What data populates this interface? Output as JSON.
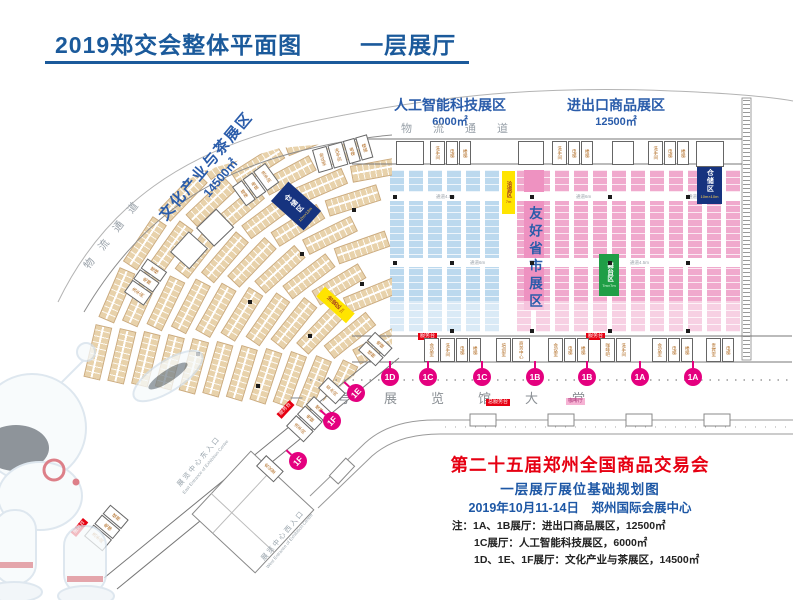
{
  "header": {
    "title": "2019郑交会整体平面图",
    "subtitle": "一层展厅"
  },
  "zones": {
    "ai_label": "人工智能科技展区",
    "ai_area": "6000㎡",
    "ie_label": "进出口商品展区",
    "ie_area": "12500㎡",
    "culture_label": "文化产业与茶展区",
    "culture_area": "14500㎡",
    "friendly_label": "友好省市展区"
  },
  "corridors": {
    "top": "物流通道",
    "left": "物流通道",
    "lobby": "一号展览馆大堂",
    "aisle": "通道4.5m",
    "aisle2": "通道6m"
  },
  "facilities": {
    "storage": "仓储区",
    "storage1_size": "10m×10m",
    "storage2_size": "12m×12m",
    "negotiation": "洽谈区",
    "negotiation_size": "7m",
    "stage": "舞台区",
    "stage_size": "7m×7m",
    "service_desk": "服务台",
    "main_service_desk": "总服务台",
    "cafe": "咖啡厅"
  },
  "gates": {
    "bottom": [
      "1D",
      "1C",
      "1C",
      "1B",
      "1B",
      "1A",
      "1A"
    ],
    "diagonal": [
      "1E",
      "1F",
      "1F"
    ]
  },
  "walls": {
    "top_clusters": [
      {
        "x": 430,
        "rooms": [
          "洗手间",
          "电梯",
          "楼梯"
        ]
      },
      {
        "x": 552,
        "rooms": [
          "洗手间",
          "电梯",
          "楼梯"
        ]
      },
      {
        "x": 648,
        "rooms": [
          "洗手间",
          "电梯",
          "楼梯"
        ]
      }
    ],
    "arc_clusters": [
      {
        "x": 312,
        "y": 150,
        "rot": -16,
        "rooms": [
          "会议室",
          "洗手间",
          "电梯",
          "楼梯"
        ]
      },
      {
        "x": 232,
        "y": 187,
        "rot": -36,
        "rooms": [
          "楼梯",
          "电梯",
          "洗手间"
        ]
      },
      {
        "x": 124,
        "y": 292,
        "rot": -55,
        "rooms": [
          "洗手间",
          "电梯",
          "楼梯"
        ]
      }
    ],
    "diag_clusters": [
      {
        "x": 358,
        "y": 350,
        "rot": -47,
        "rooms": [
          "楼梯",
          "电梯"
        ]
      },
      {
        "x": 318,
        "y": 388,
        "rot": -47,
        "rooms": [
          "茶水间"
        ]
      },
      {
        "x": 286,
        "y": 426,
        "rot": -47,
        "rooms": [
          "洗手间",
          "电梯",
          "楼梯"
        ]
      },
      {
        "x": 256,
        "y": 466,
        "rot": -47,
        "rooms": [
          "会议室"
        ]
      },
      {
        "x": 84,
        "y": 536,
        "rot": -50,
        "rooms": [
          "洗手间",
          "电梯",
          "楼梯"
        ]
      }
    ],
    "bottom_clusters": [
      {
        "x": 424,
        "rooms": [
          "会议室",
          "洗手间",
          "电梯",
          "楼梯"
        ]
      },
      {
        "x": 496,
        "rooms": [
          "培训室",
          "商务中心"
        ]
      },
      {
        "x": 548,
        "rooms": [
          "会议室",
          "电梯",
          "楼梯"
        ]
      },
      {
        "x": 600,
        "rooms": [
          "咖啡吧",
          "洗手间"
        ]
      },
      {
        "x": 652,
        "rooms": [
          "会议室",
          "电梯",
          "楼梯"
        ]
      },
      {
        "x": 706,
        "rooms": [
          "贵宾室",
          "电梯"
        ]
      }
    ]
  },
  "entrances": {
    "east_cn": "展览中心东入口",
    "east_en": "East Entrance of Exhibition Centre",
    "west_cn": "展览中心西入口",
    "west_en": "West Entrance of Exhibition Centre"
  },
  "footer": {
    "title": "第二十五届郑州全国商品交易会",
    "subtitle": "一层展厅展位基础规划图",
    "date_venue": "2019年10月11-14日　郑州国际会展中心",
    "notes": [
      "注：1A、1B展厅：进出口商品展区，12500㎡",
      "1C展厅：人工智能科技展区，6000㎡",
      "1D、1E、1F展厅：文化产业与茶展区，14500㎡"
    ]
  },
  "colors": {
    "title_blue": "#1b5a9b",
    "zone_blue": "#2a5caa",
    "red": "#e60012",
    "badge_pink": "#e4007f",
    "booth_pink": "#f0a9cd",
    "booth_blue": "#bcd9ee",
    "booth_tan": "#e8d2ab",
    "storage_blue": "#16337f",
    "stage_green": "#1f9e46",
    "negotiation_yellow": "#ffe400"
  }
}
